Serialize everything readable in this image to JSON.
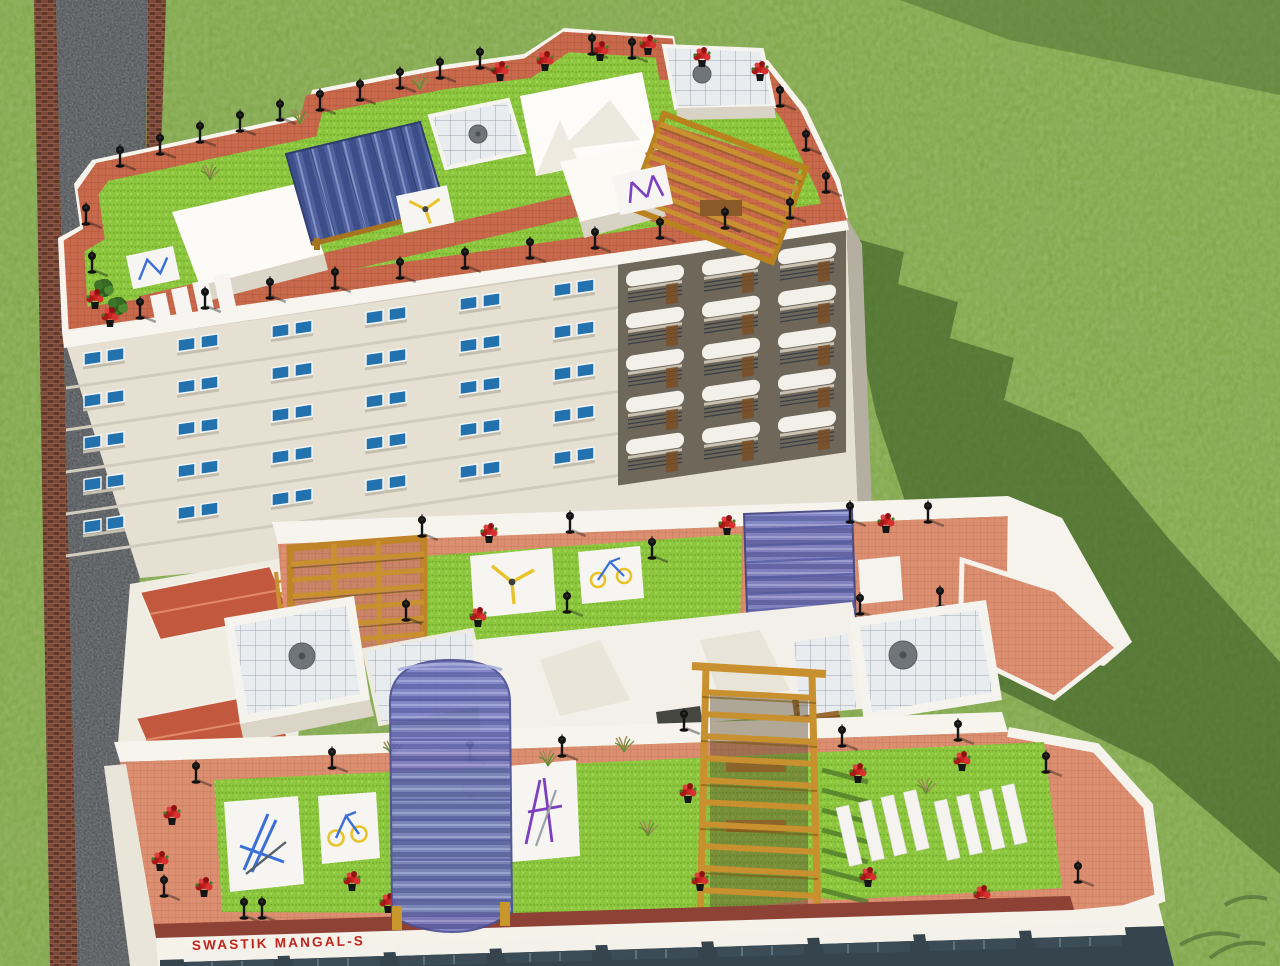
{
  "scene_title": "Aerial 3D architectural rendering of residential buildings with rooftop amenity gardens",
  "building_sign": {
    "text": "SWASTIK MANGAL-S",
    "color": "#c0241c"
  },
  "environment": {
    "ground": "grass lawn",
    "road": "asphalt access road with brick paver edging running along the left side",
    "shadow": "shadow of the rear tower cast onto the lawn at the right"
  },
  "rear_tower": {
    "label": "rear high-rise residential tower",
    "roof_features": [
      "rooftop garden with red tile paving and lawn",
      "blue glass pergola",
      "timber slat pergola",
      "machine rooms with gridded skylights and round exhaust fans",
      "black garden lamp posts",
      "red flower planters",
      "outdoor gym mats",
      "sunbed strips"
    ],
    "facade_features": [
      "cream walls",
      "paired blue windows",
      "recessed balconies with white barrel awnings"
    ]
  },
  "front_block": {
    "label": "front mid-rise block with name sign",
    "roof_features": [
      "two long terraces with salmon tile paving and bright lawns",
      "violet glass canopies",
      "timber pergola frames",
      "outdoor gym equipment on white mats",
      "white bench strips",
      "machine rooms with gridded skylights and round exhaust fans",
      "red flower planters",
      "black garden lamp posts",
      "terracotta hip roofs at the left end",
      "shop-front awnings along the base"
    ]
  },
  "palette": {
    "grass": "#7fa649",
    "grass_shadow": "#31521f",
    "road_asphalt": "#54575a",
    "brick_edge": "#7c4a3a",
    "parapet_white": "#f7f4ed",
    "facade_cream": "#e6e0d3",
    "tile_salmon": "#db8f70",
    "tile_red": "#c9694c",
    "lawn_green": "#8cc63f",
    "glass_blue": "#4d5ea3",
    "glass_violet": "#7b80c3",
    "pergola_wood": "#c8902e",
    "lamp_black": "#141414",
    "flower_red": "#c32020",
    "window_blue": "#2472ad",
    "skylight_grid": "#e8ecef",
    "vent_gray": "#70757a"
  }
}
